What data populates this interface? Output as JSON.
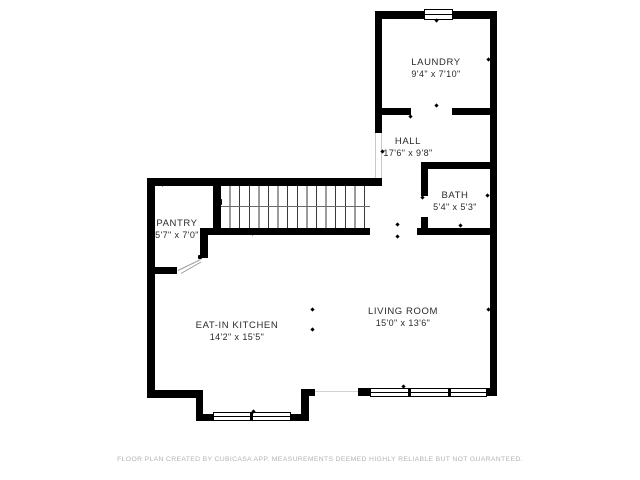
{
  "rooms": [
    {
      "name": "LAUNDRY",
      "dims": "9'4\" x 7'10\""
    },
    {
      "name": "HALL",
      "dims": "17'6\" x 9'8\""
    },
    {
      "name": "BATH",
      "dims": "5'4\" x 5'3\""
    },
    {
      "name": "PANTRY",
      "dims": "5'7\" x 7'0\""
    },
    {
      "name": "EAT-IN KITCHEN",
      "dims": "14'2\" x 15'5\""
    },
    {
      "name": "LIVING ROOM",
      "dims": "15'0\" x 13'6\""
    }
  ],
  "footer": "FLOOR PLAN CREATED BY CUBICASA APP. MEASUREMENTS DEEMED HIGHLY RELIABLE BUT NOT GUARANTEED.",
  "colors": {
    "wall": "#000000",
    "background": "#ffffff",
    "tread_line": "#3a3a3a",
    "footer_text": "#b3b3b3"
  }
}
